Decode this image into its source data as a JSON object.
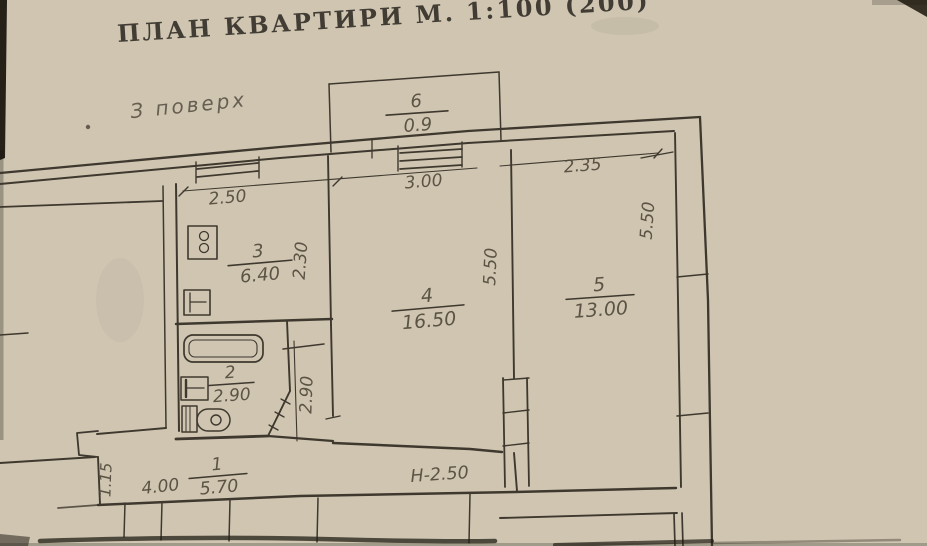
{
  "document": {
    "title": "ПЛАН КВАРТИРИ М. 1:100 (200)",
    "floor_note": "З поверх",
    "height_note": "Н-2.50"
  },
  "rooms": [
    {
      "number": "6",
      "area": "0.9"
    },
    {
      "number": "3",
      "area": "6.40"
    },
    {
      "number": "4",
      "area": "16.50"
    },
    {
      "number": "5",
      "area": "13.00"
    },
    {
      "number": "2",
      "area": "2.90"
    },
    {
      "number": "1",
      "area": "5.70"
    }
  ],
  "dimensions": {
    "kitchen_width": "2.50",
    "living_width": "3.00",
    "bedroom_width": "2.35",
    "living_depth": "5.50",
    "bedroom_depth": "5.50",
    "kitchen_depth": "2.30",
    "bath_depth": "2.90",
    "entry_width": "1.15",
    "hall_length": "4.00"
  },
  "colors": {
    "paper": "#cfc5b1",
    "ink": "#3e382e",
    "pencil": "#534b3c"
  }
}
